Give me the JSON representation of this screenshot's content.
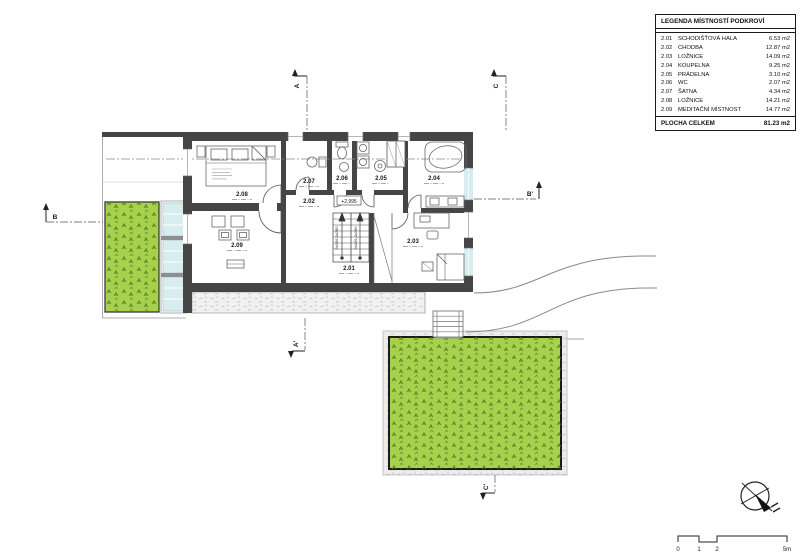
{
  "legend": {
    "title": "LEGENDA MÍSTNOSTÍ PODKROVÍ",
    "rows": [
      {
        "id": "2.01",
        "name": "SCHODIŠŤOVÁ HALA",
        "area": "6.53 m2"
      },
      {
        "id": "2.02",
        "name": "CHODBA",
        "area": "12.87 m2"
      },
      {
        "id": "2.03",
        "name": "LOŽNICE",
        "area": "14.09 m2"
      },
      {
        "id": "2.04",
        "name": "KOUPELNA",
        "area": "9.25 m2"
      },
      {
        "id": "2.05",
        "name": "PRÁDELNA",
        "area": "3.10 m2"
      },
      {
        "id": "2.06",
        "name": "WC",
        "area": "2.07 m2"
      },
      {
        "id": "2.07",
        "name": "ŠATNA",
        "area": "4.34 m2"
      },
      {
        "id": "2.08",
        "name": "LOŽNICE",
        "area": "14.21 m2"
      },
      {
        "id": "2.09",
        "name": "MEDITAČNÍ MÍSTNOST",
        "area": "14.77 m2"
      }
    ],
    "total_label": "PLOCHA CELKEM",
    "total_area": "81.23 m2"
  },
  "plan": {
    "rooms": {
      "staircase_hall": "2.01",
      "corridor": "2.02",
      "bedroom_right": "2.03",
      "bathroom": "2.04",
      "laundry": "2.05",
      "wc": "2.06",
      "wardrobe": "2.07",
      "bedroom_left": "2.08",
      "meditation": "2.09"
    },
    "level_marker": "+2,995",
    "stair_note": "9x166,4x280",
    "sections": {
      "a": "A",
      "a_prime": "A'",
      "b": "B",
      "b_prime": "B'",
      "c": "C",
      "c_prime": "C'"
    }
  },
  "scale_bar": {
    "tick0": "0",
    "tick1": "1",
    "tick2": "2",
    "tick5": "5m"
  },
  "colors": {
    "wall": "#454545",
    "grass": "#a6d14d",
    "grass_mark": "#527d1f",
    "glass": "#d8edef",
    "line": "#555555"
  }
}
